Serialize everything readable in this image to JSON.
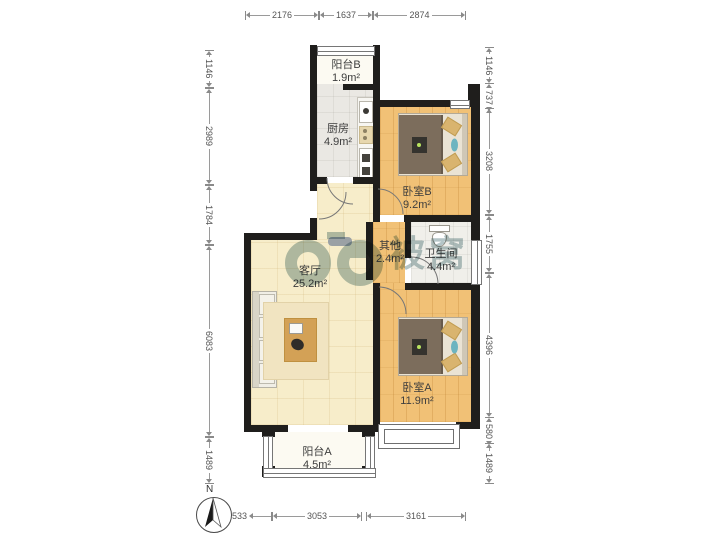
{
  "plan": {
    "type": "apartment-floor-plan",
    "rooms": [
      {
        "id": "balcony-b",
        "name": "阳台B",
        "area": "1.9m²"
      },
      {
        "id": "kitchen",
        "name": "厨房",
        "area": "4.9m²"
      },
      {
        "id": "bedroom-b",
        "name": "卧室B",
        "area": "9.2m²"
      },
      {
        "id": "other",
        "name": "其他",
        "area": "2.4m²"
      },
      {
        "id": "bathroom",
        "name": "卫生间",
        "area": "4.4m²"
      },
      {
        "id": "living-room",
        "name": "客厅",
        "area": "25.2m²"
      },
      {
        "id": "bedroom-a",
        "name": "卧室A",
        "area": "11.9m²"
      },
      {
        "id": "balcony-a",
        "name": "阳台A",
        "area": "4.5m²"
      }
    ],
    "dimensions_mm": {
      "top": [
        "2176",
        "1637",
        "2874"
      ],
      "left": [
        "1146",
        "2989",
        "1784",
        "6083",
        "1489"
      ],
      "right": [
        "1146",
        "737",
        "3208",
        "1755",
        "4396",
        "580",
        "1489"
      ],
      "bottom": [
        "533",
        "3053",
        "3161"
      ]
    },
    "compass": {
      "label": "N"
    },
    "watermark": {
      "text": "被窝"
    },
    "colors": {
      "wall": "#1f1e1c",
      "wood_floor": "#f1c176",
      "tile_floor": "#f7edca",
      "kitchen_floor": "#eae8e3",
      "bathroom_floor": "#f0efea",
      "balcony_floor": "#fcfaf2",
      "watermark": "#6e9093",
      "bed_blanket": "#7c6d5c",
      "accent_pillow": "#6db4c0"
    }
  }
}
